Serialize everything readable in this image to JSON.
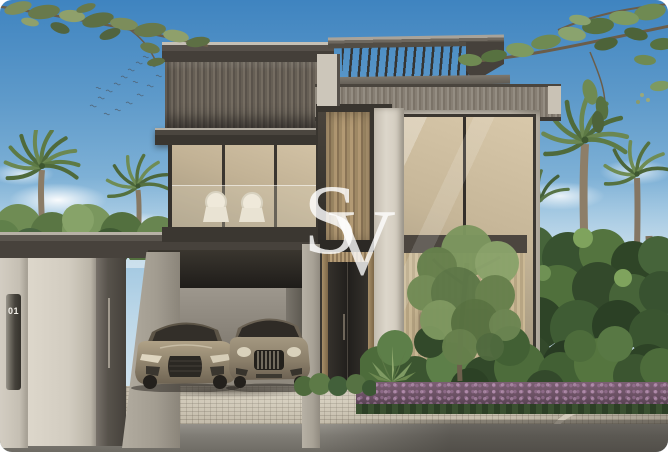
{
  "watermark": {
    "letter_s": "S",
    "letter_v": "V"
  },
  "plaque": {
    "number": "01"
  },
  "palette": {
    "sky_top": "#3f84c0",
    "sky_horizon": "#e2ecf1",
    "charcoal_fascia": "#45403a",
    "bronze_slats": "#a58a63",
    "stucco": "#d9d3c8",
    "glass_warm": "#c9b99c",
    "foliage_dark": "#33492b",
    "foliage_light": "#7f9a63",
    "flower_hedge_purple": "#72586b",
    "paving": "#c8c0ae",
    "asphalt": "#7b7872",
    "car_champagne": "#9a8e7a",
    "watermark_white": "#ffffff",
    "plaque_text": "#f2efe8"
  }
}
